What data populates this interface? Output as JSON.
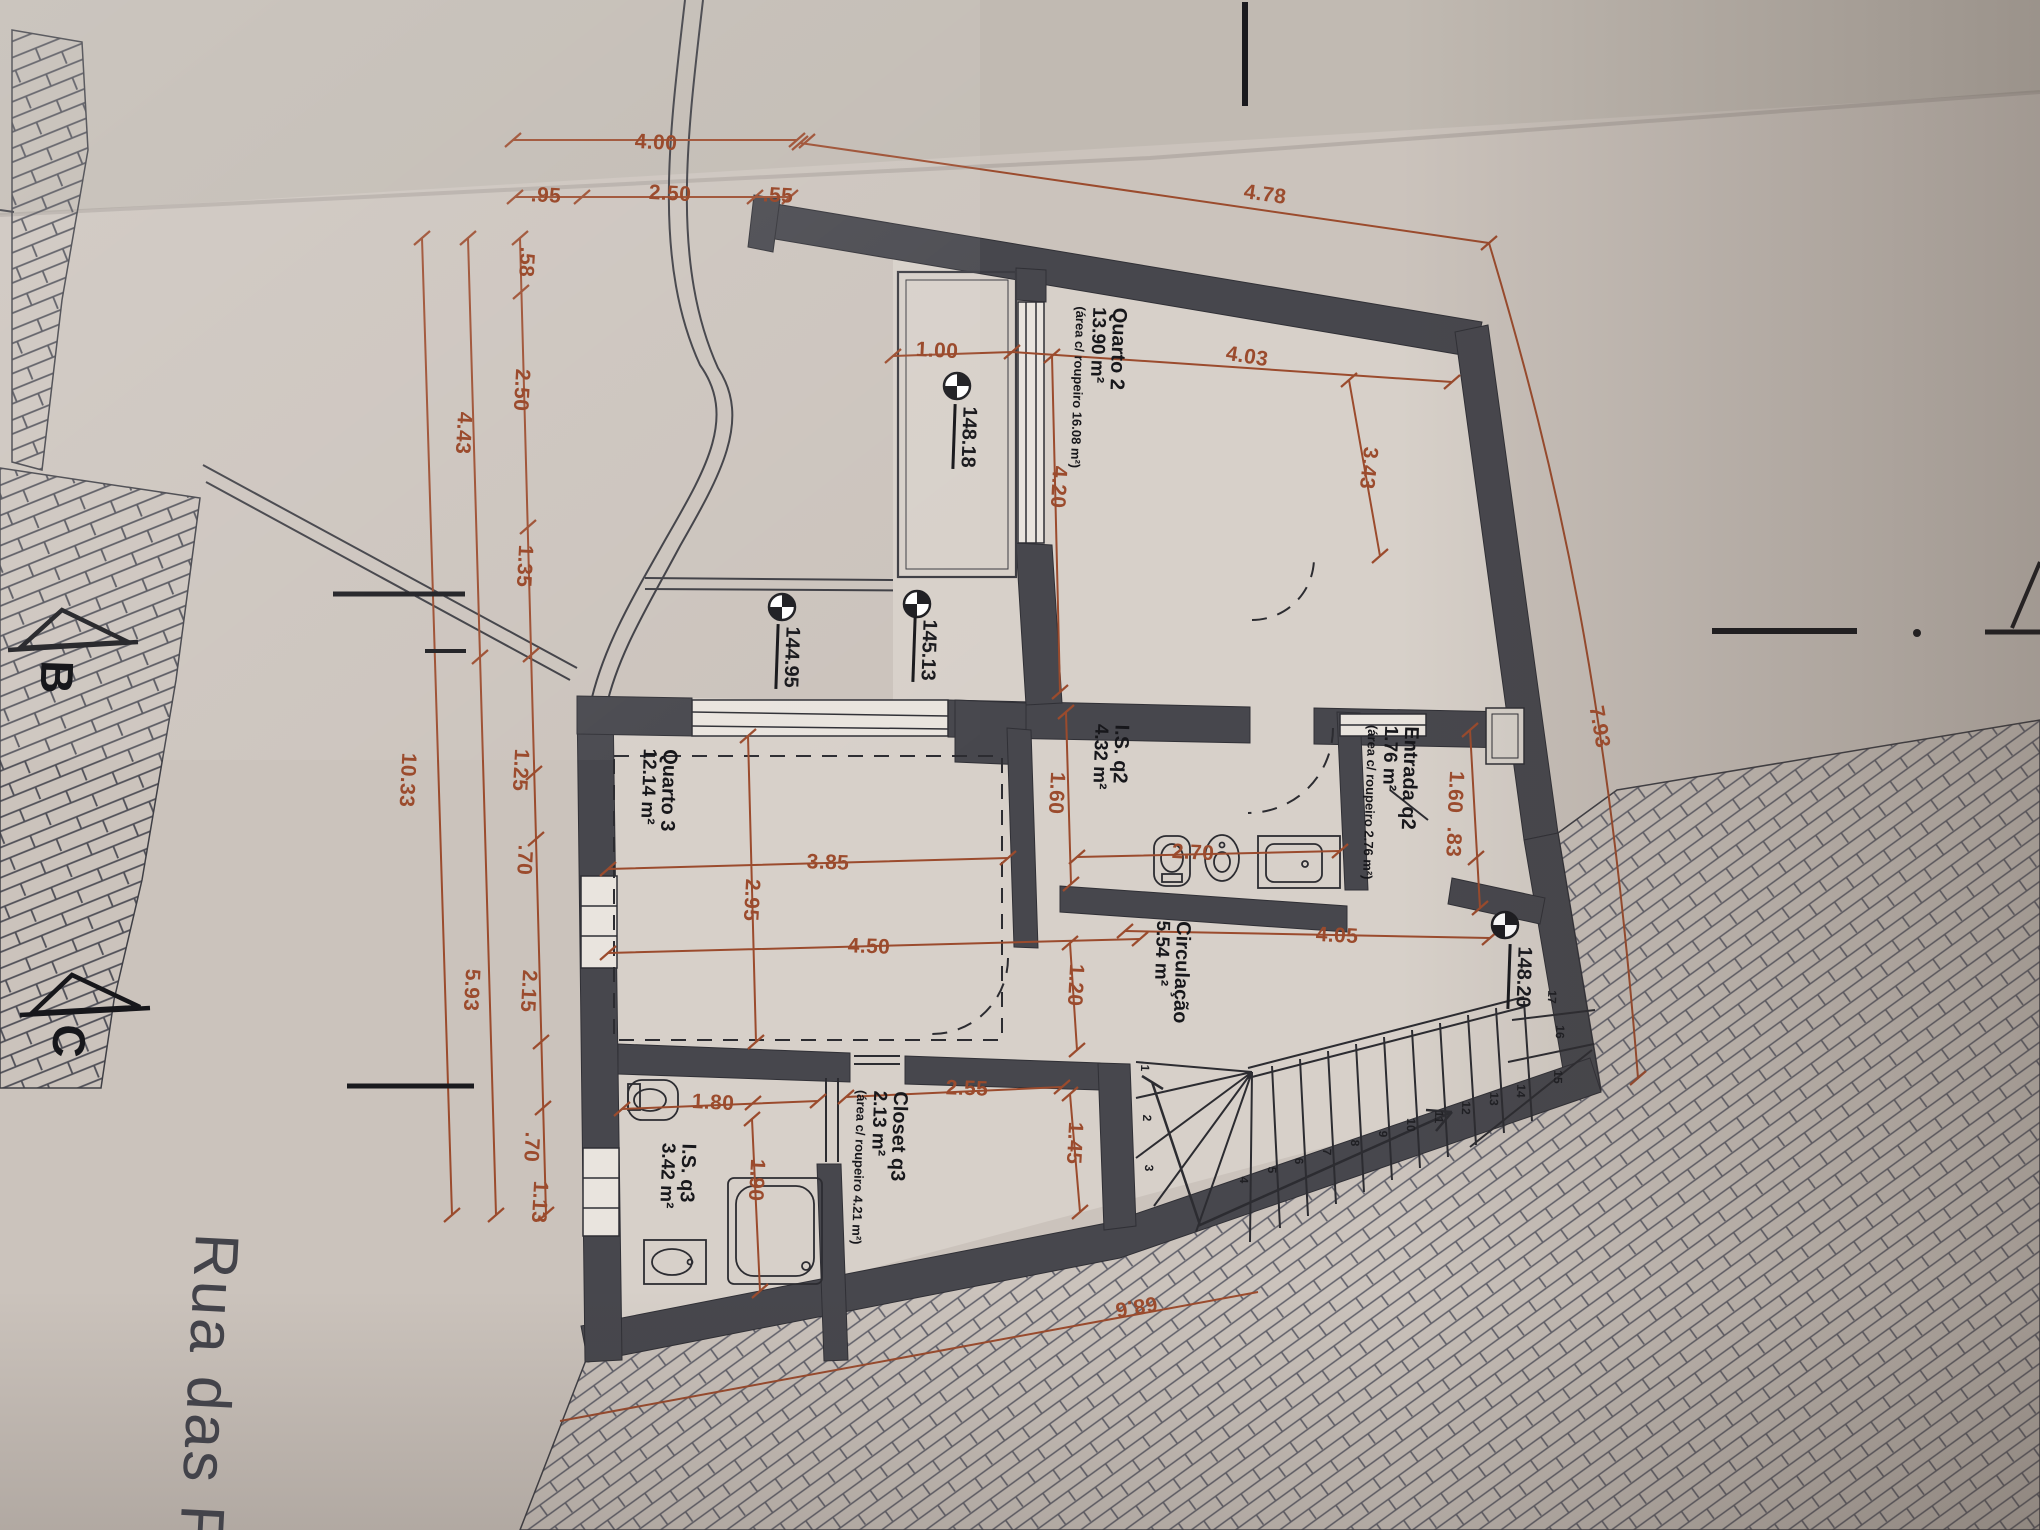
{
  "street": {
    "name": "Rua das Fl"
  },
  "sections": {
    "b": "B",
    "c": "C"
  },
  "levels": {
    "terrace": "148.18",
    "patio_a": "144.95",
    "patio_b": "145.13",
    "stair": "148.20"
  },
  "rooms": {
    "quarto2": {
      "name": "Quarto 2",
      "area": "13.90 m²",
      "note": "(área c/ roupeiro 16.08 m²)"
    },
    "quarto3": {
      "name": "Quarto 3",
      "area": "12.14 m²"
    },
    "is_q2": {
      "name": "I.S. q2",
      "area": "4.32 m²"
    },
    "entrada_q2": {
      "name": "Entrada q2",
      "area": "1.76 m²",
      "note": "(área c/ roupeiro 2.76 m²)"
    },
    "circulacao": {
      "name": "Circulação",
      "area": "5.54 m²"
    },
    "closet_q3": {
      "name": "Closet q3",
      "area": "2.13 m²",
      "note": "(área c/ roupeiro 4.21 m²)"
    },
    "is_q3": {
      "name": "I.S. q3",
      "area": "3.42 m²"
    }
  },
  "dims": {
    "top_400": "4.00",
    "top_095": ".95",
    "top_250": "2.50",
    "top_055": ".55",
    "top_478": "4.78",
    "chain_inner": [
      ".58",
      "2.50",
      "1.35",
      "1.25",
      ".70",
      "2.15",
      ".70",
      "1.13"
    ],
    "chain_mid": [
      "4.43",
      "5.93"
    ],
    "chain_outer": [
      "10.33"
    ],
    "d100": "1.00",
    "d403": "4.03",
    "d420": "4.20",
    "d343": "3.43",
    "d385": "3.85",
    "d295": "2.95",
    "d450": "4.50",
    "d160_left": "1.60",
    "d270": "2.70",
    "d160_right": "1.60",
    "d083": ".83",
    "d405": "4.05",
    "d120": "1.20",
    "d255": "2.55",
    "d145": "1.45",
    "d180": "1.80",
    "d190": "1.90",
    "d793": "7.93",
    "d686": "68.6"
  },
  "stairs": {
    "numbers": [
      "1",
      "2",
      "3",
      "4",
      "5",
      "6",
      "7",
      "8",
      "9",
      "10",
      "11",
      "12",
      "13",
      "14",
      "15",
      "16",
      "17"
    ]
  }
}
